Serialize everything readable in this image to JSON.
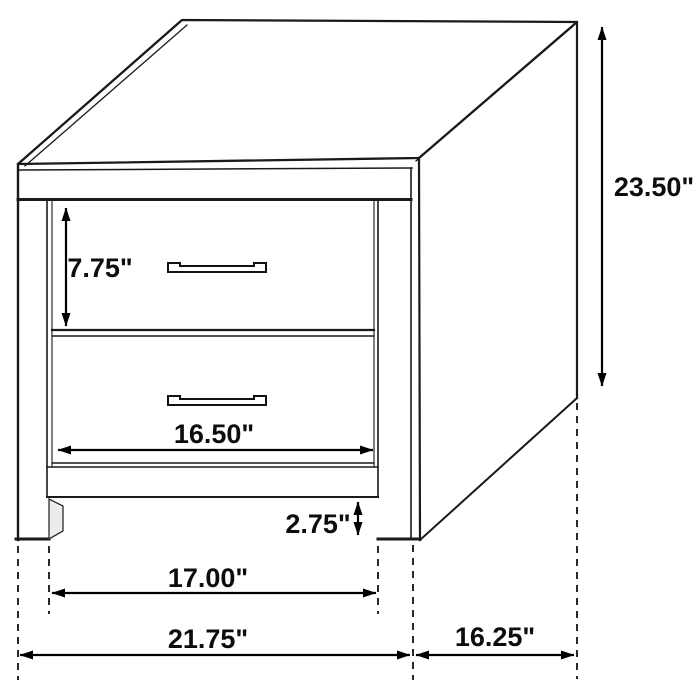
{
  "colors": {
    "background": "#ffffff",
    "line": "#1a1a1a",
    "dimension_line": "#000000",
    "text": "#0d0d0d"
  },
  "dimensions": {
    "drawer_height": "7.75\"",
    "overall_height": "23.50\"",
    "drawer_width": "16.50\"",
    "base_clearance": "2.75\"",
    "leg_span": "17.00\"",
    "overall_width": "21.75\"",
    "depth": "16.25\""
  }
}
